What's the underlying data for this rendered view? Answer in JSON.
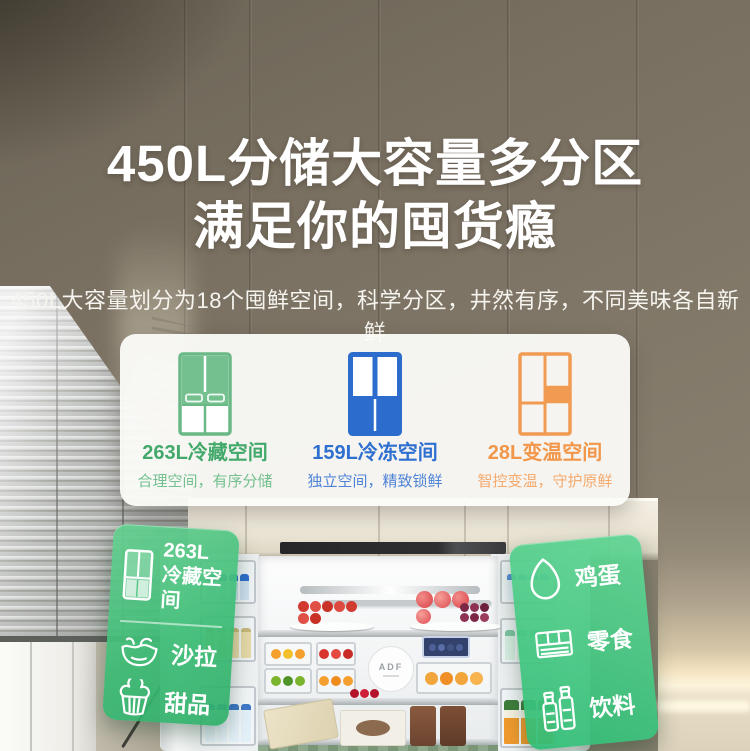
{
  "hero": {
    "title_line1": "450L分储大容量多分区",
    "title_line2": "满足你的囤货瘾",
    "subtitle": "450L大容量划分为18个囤鲜空间，科学分区，井然有序，不同美味各自新鲜"
  },
  "zones_card": {
    "zones": [
      {
        "icon": "fridge-cold-zone-icon",
        "label": "263L冷藏空间",
        "desc": "合理空间，有序分储",
        "color": "#3fa None",
        "label_color": "#43a96b",
        "desc_color": "#74c08f"
      },
      {
        "icon": "fridge-freezer-zone-icon",
        "label": "159L冷冻空间",
        "desc": "独立空间，精致锁鲜",
        "label_color": "#2e6fd0",
        "desc_color": "#4e83d6"
      },
      {
        "icon": "fridge-variable-zone-icon",
        "label": "28L变温空间",
        "desc": "智控变温，守护原鲜",
        "label_color": "#f2964a",
        "desc_color": "#f5aa6e"
      }
    ]
  },
  "left_tag": {
    "capacity": "263L",
    "zone_name": "冷藏空间",
    "items": [
      {
        "icon": "salad-icon",
        "label": "沙拉"
      },
      {
        "icon": "dessert-icon",
        "label": "甜品"
      }
    ]
  },
  "right_tag": {
    "items": [
      {
        "icon": "egg-icon",
        "label": "鸡蛋"
      },
      {
        "icon": "snack-icon",
        "label": "零食"
      },
      {
        "icon": "drink-icon",
        "label": "饮料"
      }
    ]
  },
  "fridge": {
    "logo_text": "ADF"
  },
  "colors": {
    "tag_green": "#3cbc75",
    "zone_green": "#43a96b",
    "zone_blue": "#2e6fd0",
    "zone_orange": "#f2964a",
    "wall_taupe": "#7f7667"
  }
}
